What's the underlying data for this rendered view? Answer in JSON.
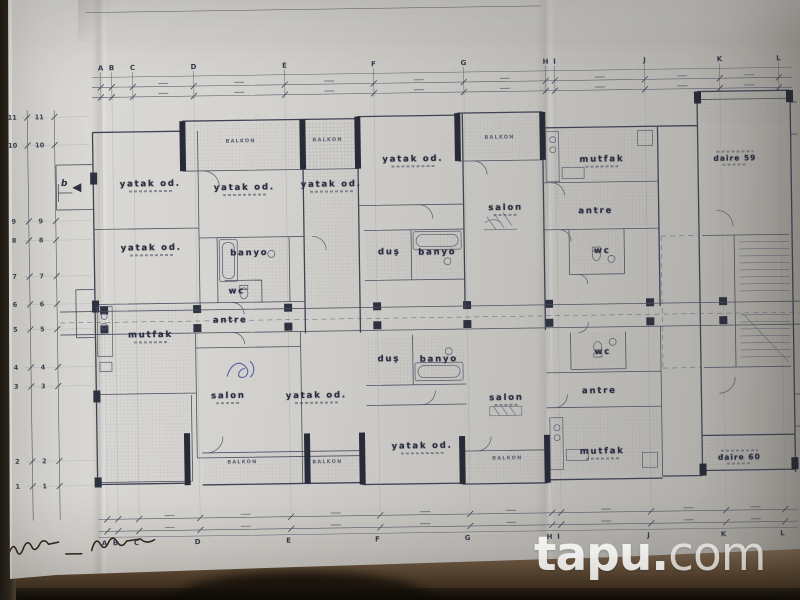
{
  "watermark": {
    "bold": "tapu.",
    "light": "com"
  },
  "palette": {
    "paper": "#cfcdc9",
    "ink": "#3e4354",
    "table": "#5e4b36",
    "logo": "#ffffff"
  },
  "plan": {
    "grid_top_y": 64,
    "grid_bottom_y": 539,
    "grid_columns": [
      {
        "label": "A",
        "x": 104
      },
      {
        "label": "B",
        "x": 115
      },
      {
        "label": "C",
        "x": 136
      },
      {
        "label": "D",
        "x": 197
      },
      {
        "label": "E",
        "x": 288
      },
      {
        "label": "F",
        "x": 377
      },
      {
        "label": "G",
        "x": 467
      },
      {
        "label": "H",
        "x": 549
      },
      {
        "label": "I",
        "x": 558
      },
      {
        "label": "J",
        "x": 648
      },
      {
        "label": "K",
        "x": 723
      },
      {
        "label": "L",
        "x": 782
      }
    ],
    "grid_rows": [
      {
        "label": "11",
        "y": 112
      },
      {
        "label": "10",
        "y": 140
      },
      {
        "label": "9",
        "y": 216
      },
      {
        "label": "8",
        "y": 235
      },
      {
        "label": "7",
        "y": 271
      },
      {
        "label": "6",
        "y": 299
      },
      {
        "label": "5",
        "y": 324
      },
      {
        "label": "4",
        "y": 362
      },
      {
        "label": "3",
        "y": 381
      },
      {
        "label": "2",
        "y": 456
      },
      {
        "label": "1",
        "y": 481
      }
    ],
    "rooms": [
      {
        "label": "BALKON",
        "x": 243,
        "y": 139,
        "kind": "small"
      },
      {
        "label": "BALKON",
        "x": 330,
        "y": 139,
        "kind": "small"
      },
      {
        "label": "BALKON",
        "x": 502,
        "y": 139,
        "kind": "small"
      },
      {
        "label": "yatak od.",
        "x": 152,
        "y": 182,
        "kind": "room",
        "dims": true
      },
      {
        "label": "yatak od.",
        "x": 246,
        "y": 187,
        "kind": "room",
        "dims": true
      },
      {
        "label": "yatak od.",
        "x": 333,
        "y": 185,
        "kind": "room",
        "dims": true
      },
      {
        "label": "yatak od.",
        "x": 415,
        "y": 161,
        "kind": "room",
        "dims": true
      },
      {
        "label": "mutfak",
        "x": 604,
        "y": 164,
        "kind": "room",
        "dims": true
      },
      {
        "label": "salon",
        "x": 507,
        "y": 211,
        "kind": "room",
        "dims": true
      },
      {
        "label": "antre",
        "x": 597,
        "y": 214,
        "kind": "room"
      },
      {
        "label": "yatak od.",
        "x": 152,
        "y": 246,
        "kind": "room",
        "dims": true
      },
      {
        "label": "banyo",
        "x": 250,
        "y": 251,
        "kind": "room"
      },
      {
        "label": "duş",
        "x": 390,
        "y": 252,
        "kind": "room"
      },
      {
        "label": "banyo",
        "x": 438,
        "y": 253,
        "kind": "room"
      },
      {
        "label": "wc",
        "x": 237,
        "y": 289,
        "kind": "room"
      },
      {
        "label": "wc",
        "x": 603,
        "y": 254,
        "kind": "room"
      },
      {
        "label": "antre",
        "x": 230,
        "y": 318,
        "kind": "room"
      },
      {
        "label": "daire 59",
        "x": 737,
        "y": 163,
        "kind": "unit"
      },
      {
        "label": "mutfak",
        "x": 150,
        "y": 333,
        "kind": "room",
        "dims": true
      },
      {
        "label": "salon",
        "x": 227,
        "y": 395,
        "kind": "room",
        "dims": true
      },
      {
        "label": "yatak od.",
        "x": 315,
        "y": 396,
        "kind": "room",
        "dims": true
      },
      {
        "label": "duş",
        "x": 388,
        "y": 359,
        "kind": "room"
      },
      {
        "label": "banyo",
        "x": 438,
        "y": 360,
        "kind": "room"
      },
      {
        "label": "salon",
        "x": 505,
        "y": 401,
        "kind": "room",
        "dims": true
      },
      {
        "label": "wc",
        "x": 602,
        "y": 355,
        "kind": "room"
      },
      {
        "label": "antre",
        "x": 598,
        "y": 394,
        "kind": "room"
      },
      {
        "label": "mutfak",
        "x": 600,
        "y": 456,
        "kind": "room",
        "dims": true
      },
      {
        "label": "yatak od.",
        "x": 420,
        "y": 448,
        "kind": "room",
        "dims": true
      },
      {
        "label": "BALKON",
        "x": 240,
        "y": 460,
        "kind": "small"
      },
      {
        "label": "BALKON",
        "x": 325,
        "y": 461,
        "kind": "small"
      },
      {
        "label": "BALKON",
        "x": 505,
        "y": 460,
        "kind": "small"
      },
      {
        "label": "daire 60",
        "x": 737,
        "y": 462,
        "kind": "unit"
      },
      {
        "label": "b",
        "x": 66,
        "y": 179,
        "kind": "marker"
      }
    ]
  }
}
